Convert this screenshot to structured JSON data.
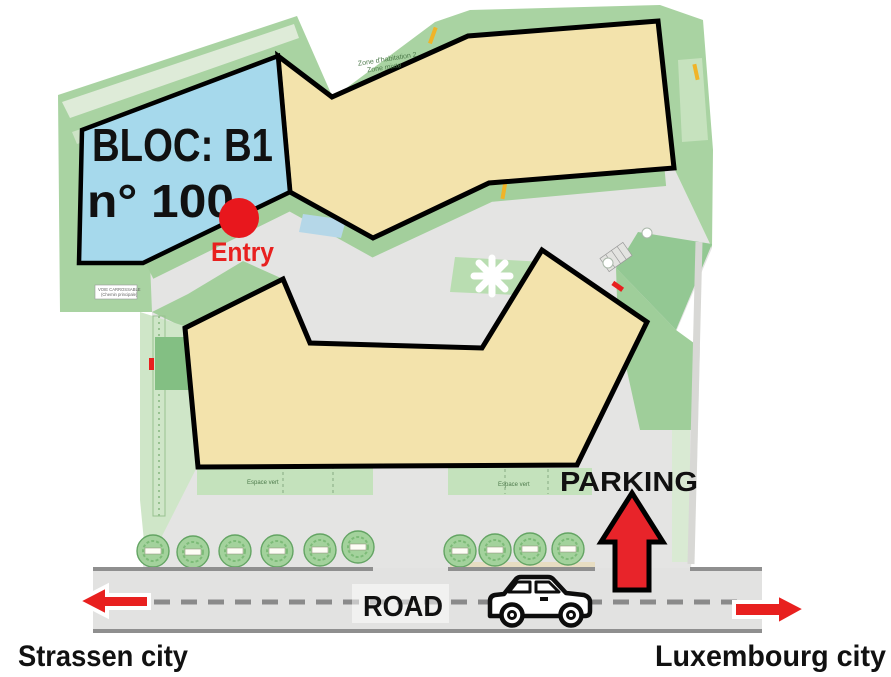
{
  "map": {
    "bloc": {
      "line1": "BLOC: B1",
      "line2": "n° 100"
    },
    "entry_label": "Entry",
    "parking_label": "PARKING",
    "road_label": "ROAD",
    "left_city_label": "Strassen city",
    "right_city_label": "Luxembourg city",
    "zone_note": {
      "line1": "Zone d'habitation 2",
      "line2": "Zone mixte"
    },
    "green_space_label_left": "Espace vert",
    "green_space_label_right": "Espace vert",
    "roadway_note": {
      "line1": "VOIE CARROSSABLE",
      "line2": "(Chemin principale)"
    }
  },
  "legend_colors": {
    "bloc_fill": "#a6d9ec",
    "building_fill": "#f3e3ac",
    "outline": "#000000",
    "accent_red": "#e8201f",
    "green_main": "#a9d3a2",
    "green_pale": "#cfe6c8",
    "plaza_gray": "#e4e4e3",
    "road_gray": "#e2e2e1",
    "dash_gray": "#8a8a8a"
  }
}
